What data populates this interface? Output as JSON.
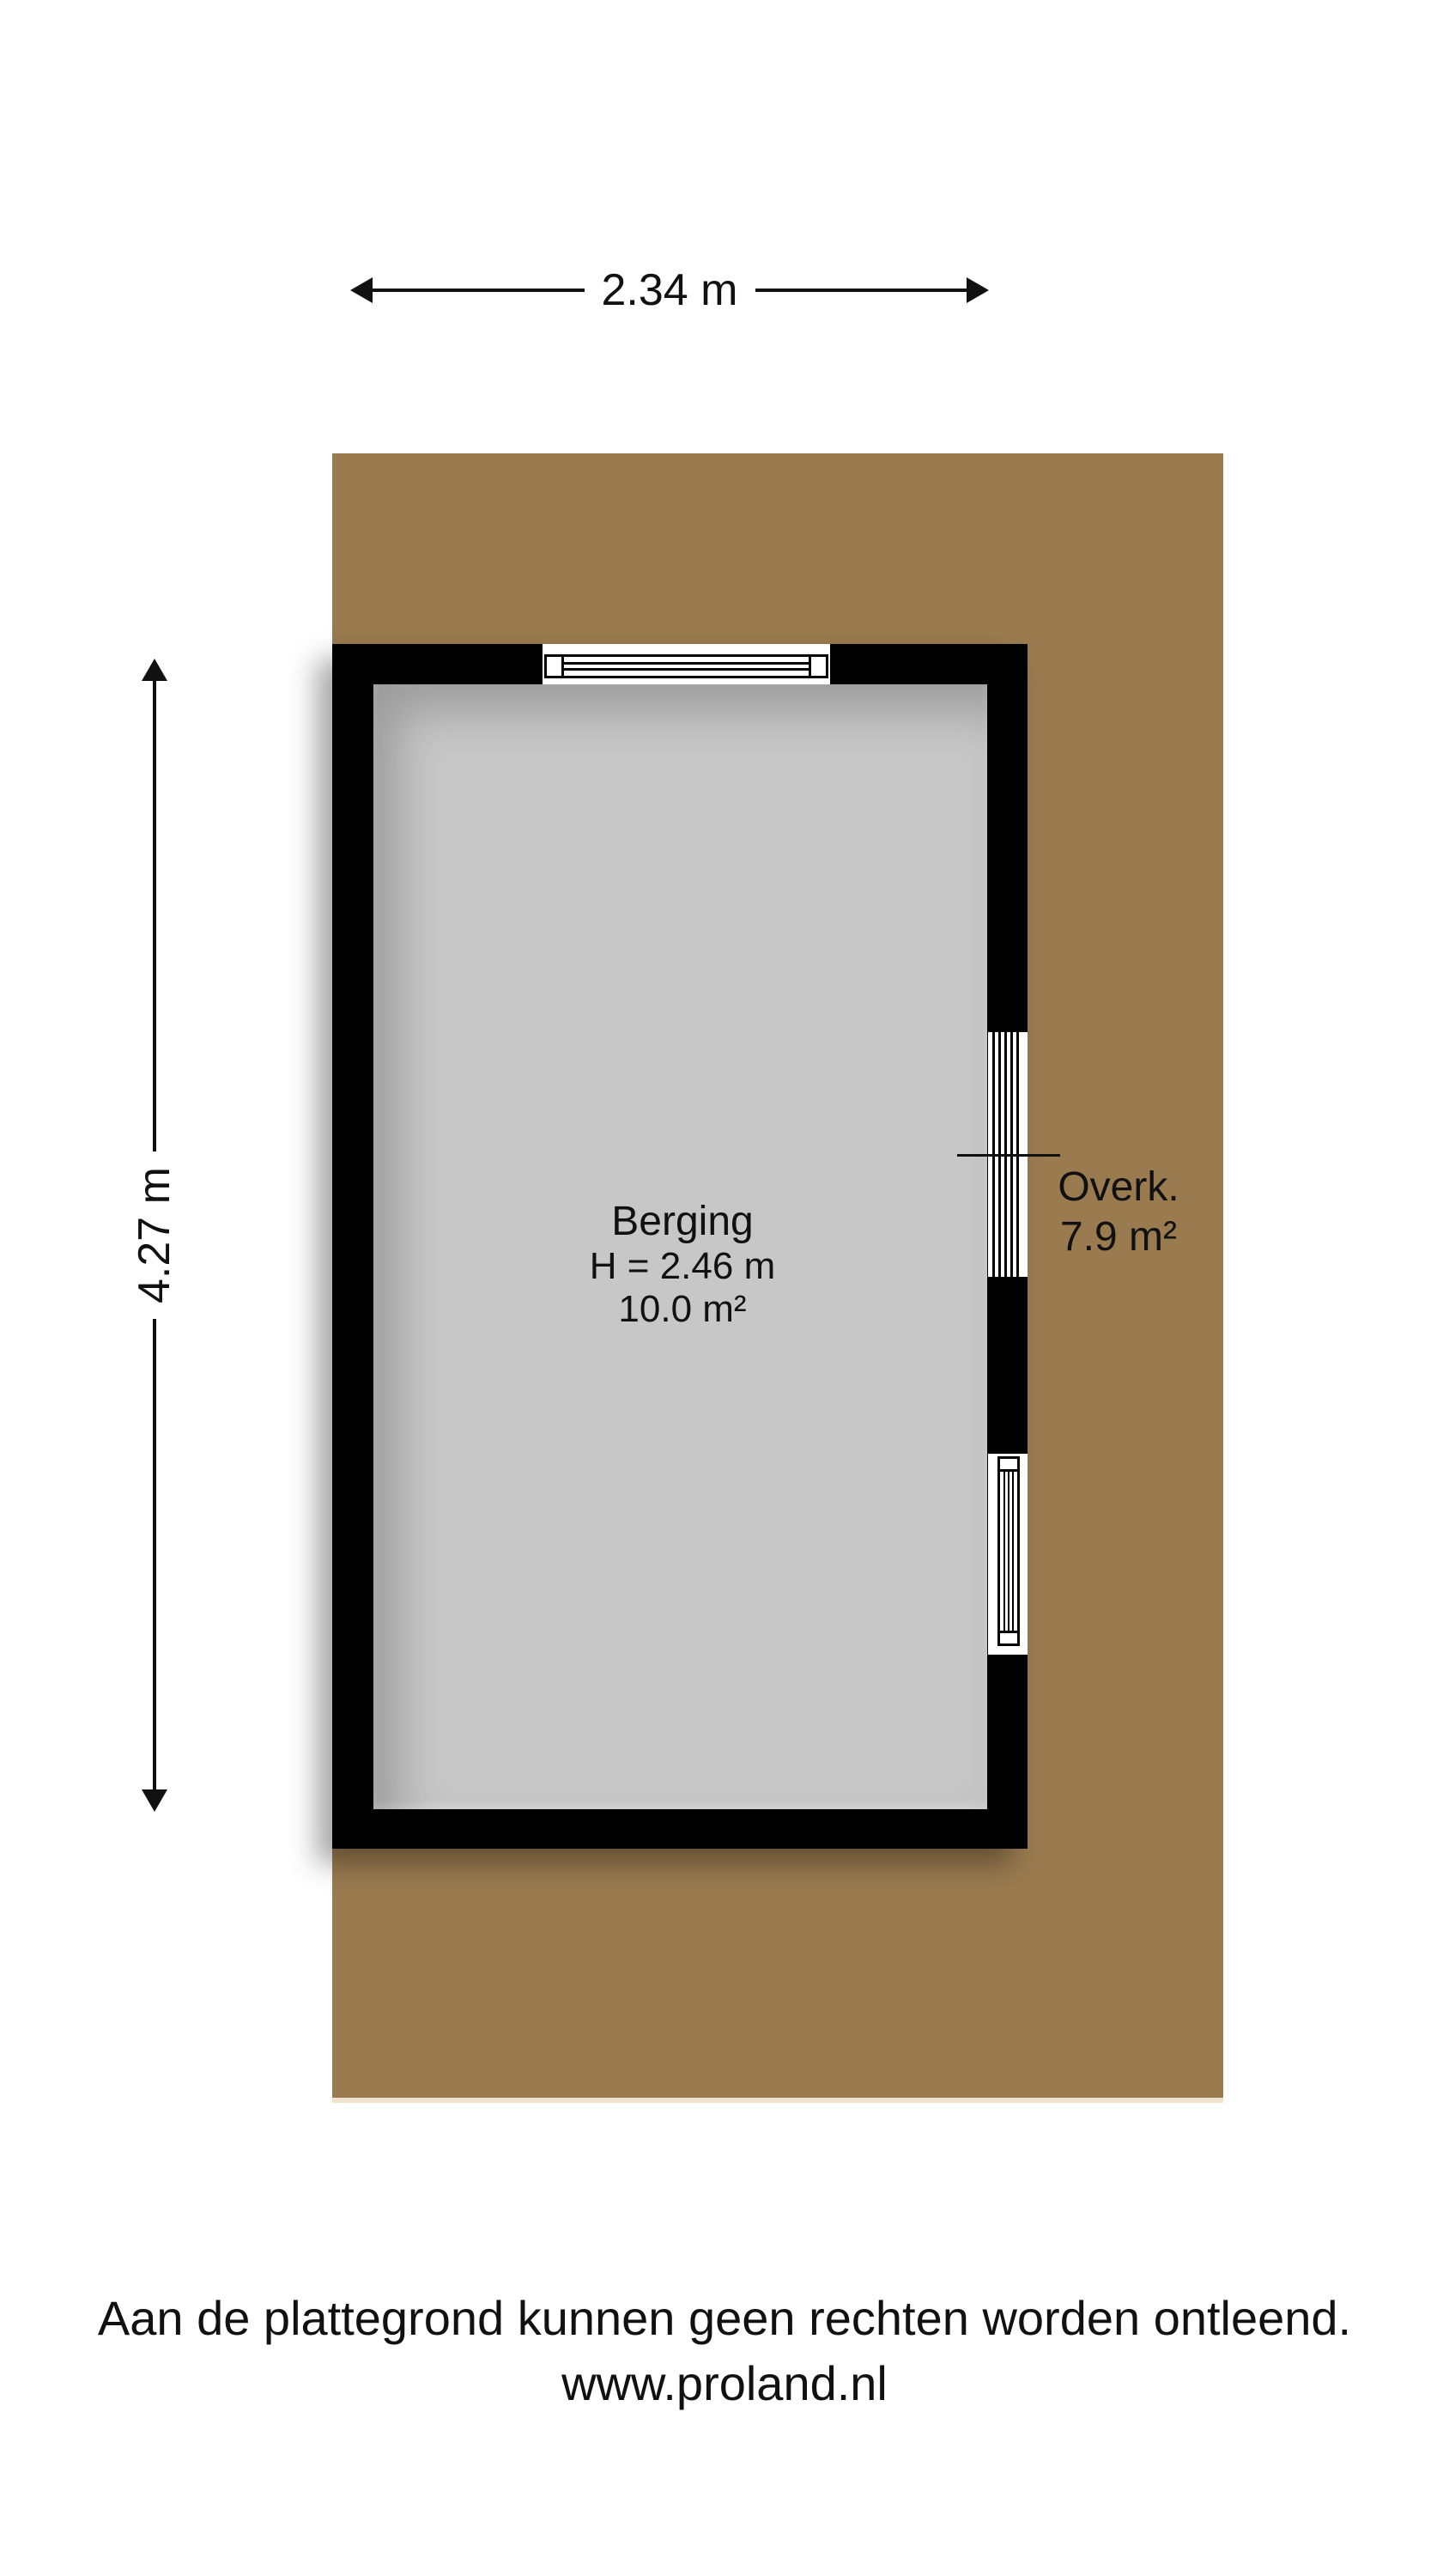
{
  "dimensions": {
    "width_label": "2.34 m",
    "height_label": "4.27 m",
    "width_m": 2.34,
    "height_m": 4.27
  },
  "rooms": [
    {
      "name": "Berging",
      "height_label": "H = 2.46 m",
      "area_label": "10.0 m²",
      "area_m2": 10.0,
      "ceiling_height_m": 2.46
    },
    {
      "name": "Overk.",
      "area_label": "7.9 m²",
      "area_m2": 7.9
    }
  ],
  "footer": {
    "disclaimer": "Aan de plattegrond kunnen geen rechten worden ontleend.",
    "website": "www.proland.nl"
  },
  "colors": {
    "plot_brown": "#9A7B50",
    "plot_edge_light": "#EFE3CB",
    "interior_gray": "#C7C7C7",
    "wall_black": "#000000",
    "text": "#111111"
  }
}
